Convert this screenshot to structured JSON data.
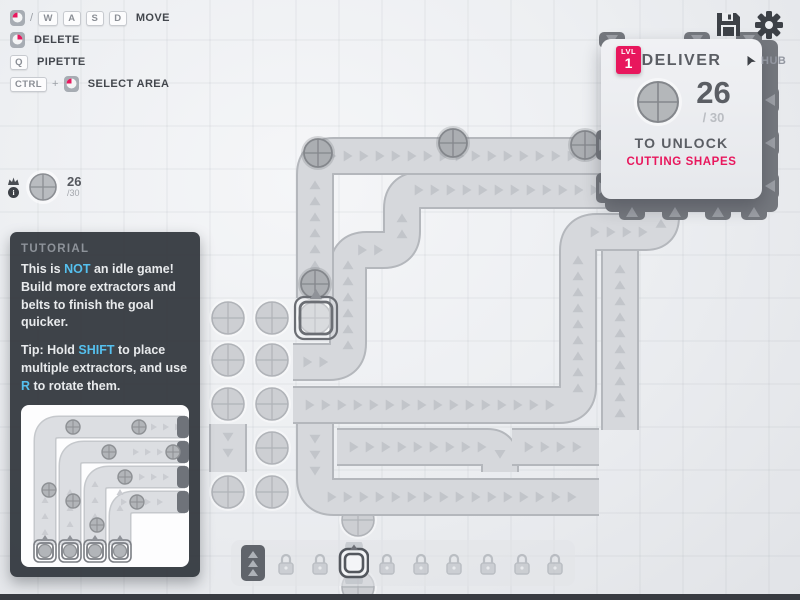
{
  "hints": {
    "move": {
      "slash": "/",
      "keys": [
        "W",
        "A",
        "S",
        "D"
      ],
      "label": "MOVE"
    },
    "delete": {
      "label": "DELETE"
    },
    "pipette": {
      "key": "Q",
      "label": "PIPETTE"
    },
    "select": {
      "key": "CTRL",
      "plus": "+",
      "label": "SELECT AREA"
    }
  },
  "goal_pin": {
    "value": "26",
    "total": "/30"
  },
  "hub": {
    "lvl_label": "LVL",
    "lvl": "1",
    "deliver": "DELIVER",
    "count": "26",
    "of": "/ 30",
    "unlock": "TO UNLOCK",
    "reward": "CUTTING SHAPES",
    "map_label": "HUB"
  },
  "tutorial": {
    "title": "TUTORIAL",
    "p1": [
      {
        "t": "This is "
      },
      {
        "t": "NOT",
        "hl": true
      },
      {
        "t": " an idle game! Build more extractors and belts to finish the goal quicker."
      }
    ],
    "p2": [
      {
        "t": "Tip: Hold "
      },
      {
        "t": "SHIFT",
        "hl": true
      },
      {
        "t": " to place multiple extractors, and use "
      },
      {
        "t": "R",
        "hl": true
      },
      {
        "t": " to rotate them."
      }
    ]
  },
  "toolbar": {
    "slots": [
      "belt",
      "locked",
      "locked",
      "miner-selected",
      "locked",
      "locked",
      "locked",
      "locked",
      "locked",
      "locked"
    ]
  },
  "icons": {
    "top_right": [
      "save",
      "settings"
    ]
  },
  "colors": {
    "accent_pink": "#e8175d",
    "hint_blue": "#55c0ee",
    "belt": "#d6d8dc",
    "hub_gray": "#75787e"
  }
}
